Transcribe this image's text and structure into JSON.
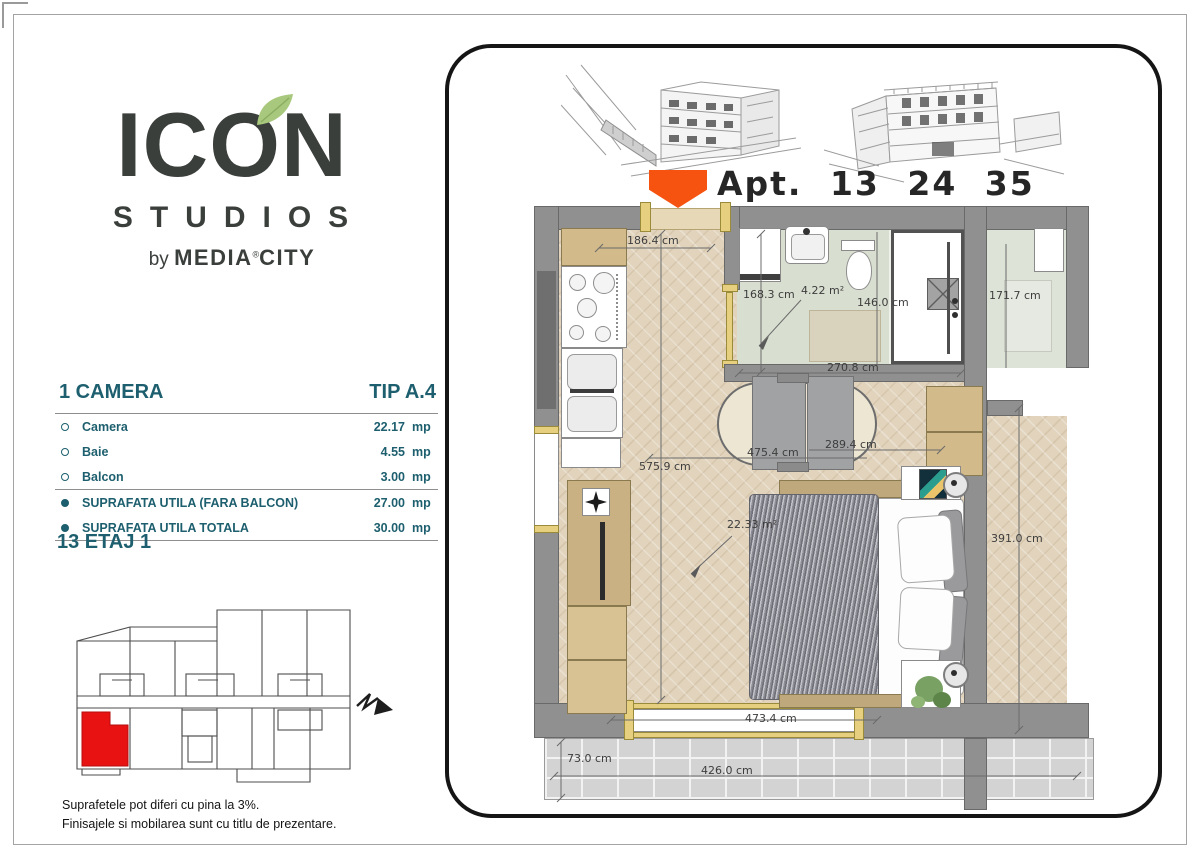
{
  "colors": {
    "teal": "#1d5f6e",
    "logo_dark": "#3b3f3c",
    "leaf_green": "#a7c87d",
    "accent_orange": "#f5530f",
    "unit_red": "#e81212",
    "wall_gray": "#909090"
  },
  "logo": {
    "name_left": "IC",
    "name_o": "O",
    "name_right": "N",
    "studios": "STUDIOS",
    "by": "by",
    "brand_a": "MEDIA",
    "reg": "®",
    "brand_b": "CITY"
  },
  "spec": {
    "title": "1 CAMERA",
    "type": "TIP A.4",
    "rows": [
      {
        "label": "Camera",
        "value": "22.17",
        "unit": "mp"
      },
      {
        "label": "Baie",
        "value": "4.55",
        "unit": "mp"
      },
      {
        "label": "Balcon",
        "value": "3.00",
        "unit": "mp"
      },
      {
        "label": "SUPRAFATA UTILA (FARA BALCON)",
        "value": "27.00",
        "unit": "mp"
      },
      {
        "label": "SUPRAFATA UTILA TOTALA",
        "value": "30.00",
        "unit": "mp"
      }
    ]
  },
  "floor": {
    "label": "13 ETAJ 1"
  },
  "disclaimer": {
    "line1": "Suprafetele pot diferi cu pina la 3%.",
    "line2": "Finisajele si mobilarea sunt cu titlu de prezentare."
  },
  "plan": {
    "apt_label": "Apt. 13 24 35",
    "dims": {
      "entry_width": "186.4 cm",
      "bath_height": "168.3 cm",
      "bath_area": "4.22 m²",
      "shower_width": "146.0 cm",
      "adjacent_height": "171.7 cm",
      "bath_width": "270.8 cm",
      "sofa_width": "289.4 cm",
      "room_width": "475.4 cm",
      "room_height": "575.9 cm",
      "bedroom_area": "22.33 m²",
      "right_height": "391.0 cm",
      "window_width": "473.4 cm",
      "balcony_depth": "73.0 cm",
      "balcony_width": "426.0 cm"
    }
  }
}
